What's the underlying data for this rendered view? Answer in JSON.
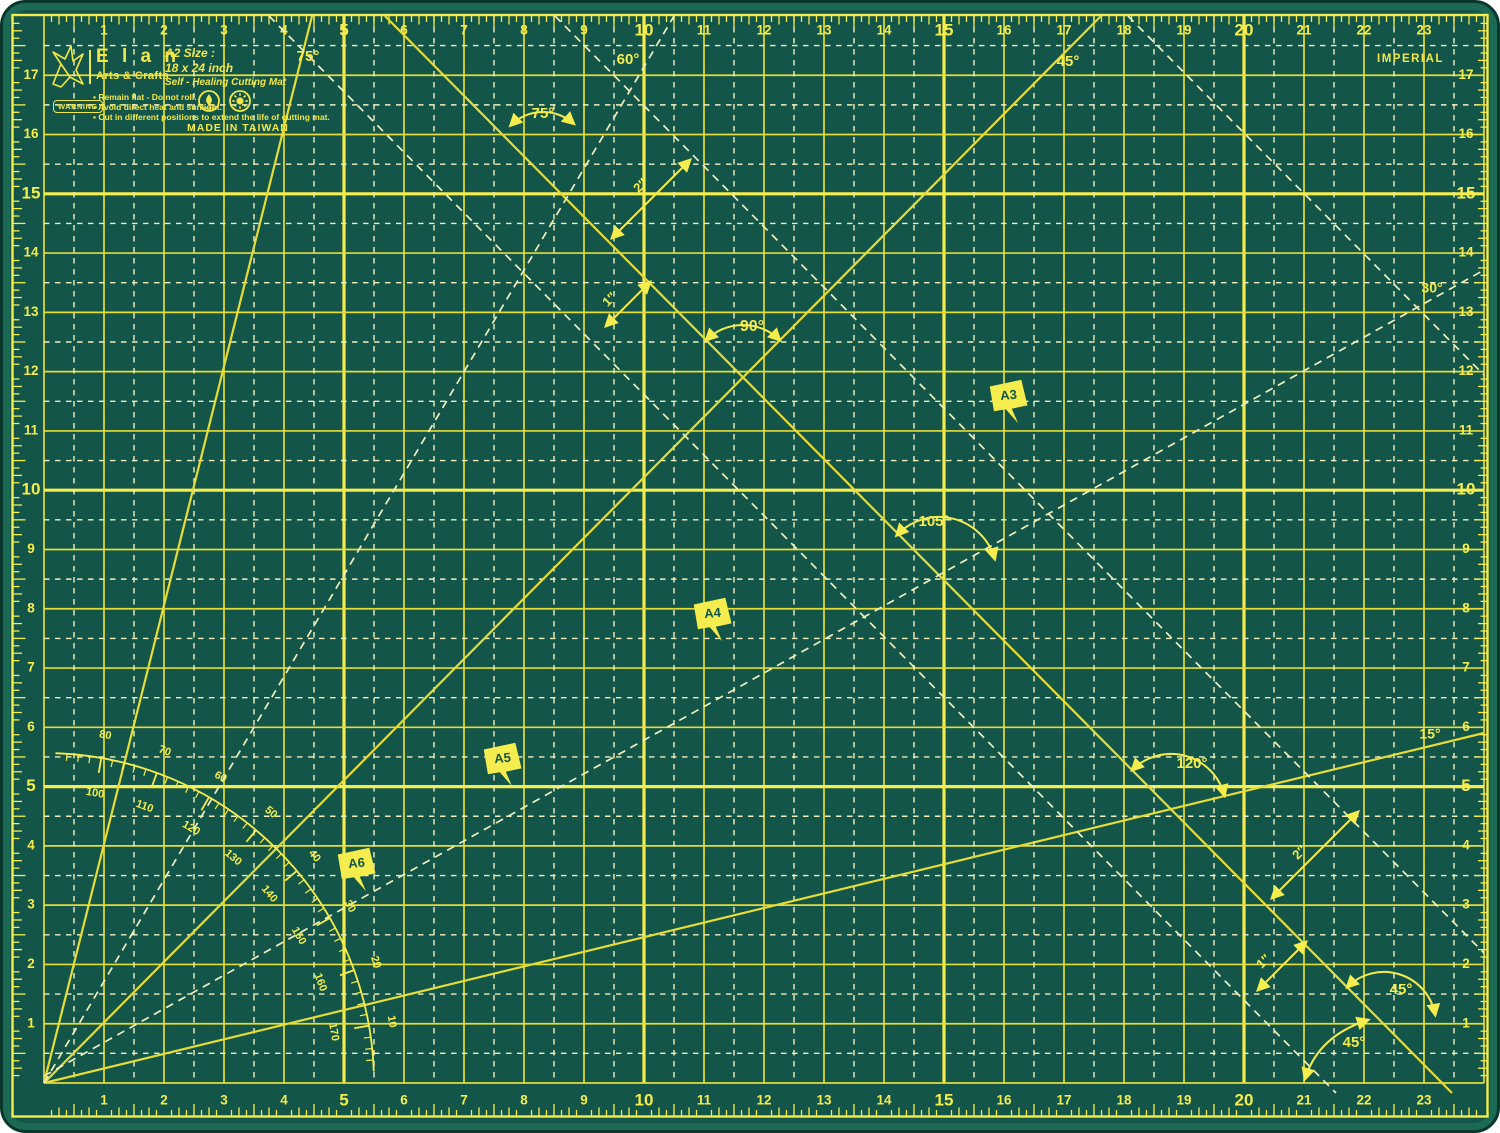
{
  "title": "Elan Arts & Crafts A2 Self-Healing Cutting Mat",
  "colors": {
    "frame": "#1d6a54",
    "surface": "#135649",
    "rim": "#0a372d",
    "line": "#e6dc39",
    "line_bold": "#f5ec4e",
    "dash": "#efefbe",
    "flag_text": "#14554a"
  },
  "header": {
    "brand": "E l a n",
    "brand_sub": "Arts & Crafts",
    "size_label": "A2 Size :",
    "size_value": "18 x 24 inch",
    "product_name": "Self - Healing Cutting Mat",
    "warning_label": "WARNING",
    "warnings": [
      "Remain flat - Do not roll.",
      "Avoid direct heat and sunlight.",
      "Cut in different positions to extend the life of cutting mat."
    ],
    "made_in": "MADE IN TAIWAN",
    "unit_system": "IMPERIAL"
  },
  "rulers": {
    "top_numbers": [
      1,
      2,
      3,
      4,
      5,
      6,
      7,
      8,
      9,
      10,
      11,
      12,
      13,
      14,
      15,
      16,
      17,
      18,
      19,
      20,
      21,
      22,
      23
    ],
    "side_numbers": [
      1,
      2,
      3,
      4,
      5,
      6,
      7,
      8,
      9,
      10,
      11,
      12,
      13,
      14,
      15,
      16,
      17
    ],
    "bold_every": 5
  },
  "grid": {
    "cols": 24,
    "rows": 18
  },
  "protractor": {
    "outer_labels": [
      10,
      20,
      30,
      40,
      50,
      60,
      70,
      80
    ],
    "inner_labels": [
      170,
      160,
      150,
      140,
      130,
      120,
      110,
      100
    ]
  },
  "angle_labels": [
    {
      "text": "75°",
      "x": 308,
      "y": 57,
      "size": 15,
      "name": "angle-label-75-top"
    },
    {
      "text": "60°",
      "x": 628,
      "y": 60,
      "size": 15,
      "name": "angle-label-60-top"
    },
    {
      "text": "45°",
      "x": 1068,
      "y": 62,
      "size": 15,
      "name": "angle-label-45-top"
    },
    {
      "text": "75°",
      "x": 543,
      "y": 114,
      "size": 15,
      "name": "angle-label-75-arc"
    },
    {
      "text": "90°",
      "x": 752,
      "y": 327,
      "size": 16,
      "name": "angle-label-90"
    },
    {
      "text": "30°",
      "x": 1432,
      "y": 289,
      "size": 14,
      "name": "angle-label-30-right"
    },
    {
      "text": "105°",
      "x": 934,
      "y": 522,
      "size": 15,
      "name": "angle-label-105"
    },
    {
      "text": "15°",
      "x": 1430,
      "y": 735,
      "size": 14,
      "name": "angle-label-15-right"
    },
    {
      "text": "120°",
      "x": 1192,
      "y": 764,
      "size": 15,
      "name": "angle-label-120"
    },
    {
      "text": "45°",
      "x": 1401,
      "y": 990,
      "size": 15,
      "name": "angle-label-45-br-upper"
    },
    {
      "text": "45°",
      "x": 1354,
      "y": 1043,
      "size": 15,
      "name": "angle-label-45-br-lower"
    }
  ],
  "angle_arcs": [
    {
      "d": "M510.5,125.5 A46,46 0 0 1 573.8,123.8",
      "name": "angle-arc-75"
    },
    {
      "d": "M706.2,340.2 A52,52 0 0 1 779.8,340.2",
      "name": "angle-arc-90"
    },
    {
      "d": "M896.6,535.4 A58,58 0 0 1 994.8,559",
      "name": "angle-arc-105"
    },
    {
      "d": "M1132.1,770.1 A55,55 0 0 1 1224.4,795.7",
      "name": "angle-arc-120"
    },
    {
      "d": "M1347.2,987.2 A52,52 0 0 1 1435.2,1015",
      "name": "angle-arc-45-upper"
    },
    {
      "d": "M1368,1020 Q1318,1036 1305,1079",
      "name": "angle-arc-45-lower"
    }
  ],
  "diagonals": {
    "solid": [
      {
        "name": "line-75deg",
        "x1": 44,
        "y1": 1083,
        "x2": 312,
        "y2": 16
      },
      {
        "name": "line-45deg-ascending",
        "x1": 44,
        "y1": 1083,
        "x2": 1101,
        "y2": 16
      },
      {
        "name": "line-45deg-descending",
        "x1": 385,
        "y1": 16,
        "x2": 1452,
        "y2": 1093
      },
      {
        "name": "line-15deg",
        "x1": 44,
        "y1": 1083,
        "x2": 1484,
        "y2": 733
      }
    ],
    "dashed": [
      {
        "name": "line-60deg-dashed",
        "x1": 44,
        "y1": 1083,
        "x2": 674,
        "y2": 16
      },
      {
        "name": "line-30deg-dashed",
        "x1": 44,
        "y1": 1076,
        "x2": 1484,
        "y2": 270
      },
      {
        "name": "line-45deg-dashed-a",
        "x1": 269,
        "y1": 16,
        "x2": 1336,
        "y2": 1093
      },
      {
        "name": "line-45deg-dashed-b",
        "x1": 555,
        "y1": 16,
        "x2": 1484,
        "y2": 953
      },
      {
        "name": "line-45deg-dashed-c",
        "x1": 1128,
        "y1": 16,
        "x2": 1484,
        "y2": 375
      }
    ]
  },
  "measure_arrows": [
    {
      "text": "2″",
      "x1": 612,
      "y1": 238,
      "x2": 690,
      "y2": 160,
      "lx": 641,
      "ly": 186,
      "name": "measure-2in-upper"
    },
    {
      "text": "1″",
      "x1": 606,
      "y1": 326,
      "x2": 650,
      "y2": 282,
      "lx": 610,
      "ly": 300,
      "name": "measure-1in-upper"
    },
    {
      "text": "2″",
      "x1": 1272,
      "y1": 898,
      "x2": 1358,
      "y2": 812,
      "lx": 1300,
      "ly": 853,
      "name": "measure-2in-lower"
    },
    {
      "text": "1″",
      "x1": 1258,
      "y1": 990,
      "x2": 1306,
      "y2": 942,
      "lx": 1264,
      "ly": 962,
      "name": "measure-1in-lower"
    }
  ],
  "size_flags": [
    {
      "label": "A3",
      "x": 1008,
      "y": 400
    },
    {
      "label": "A4",
      "x": 712,
      "y": 618
    },
    {
      "label": "A5",
      "x": 502,
      "y": 763
    },
    {
      "label": "A6",
      "x": 356,
      "y": 868
    }
  ]
}
